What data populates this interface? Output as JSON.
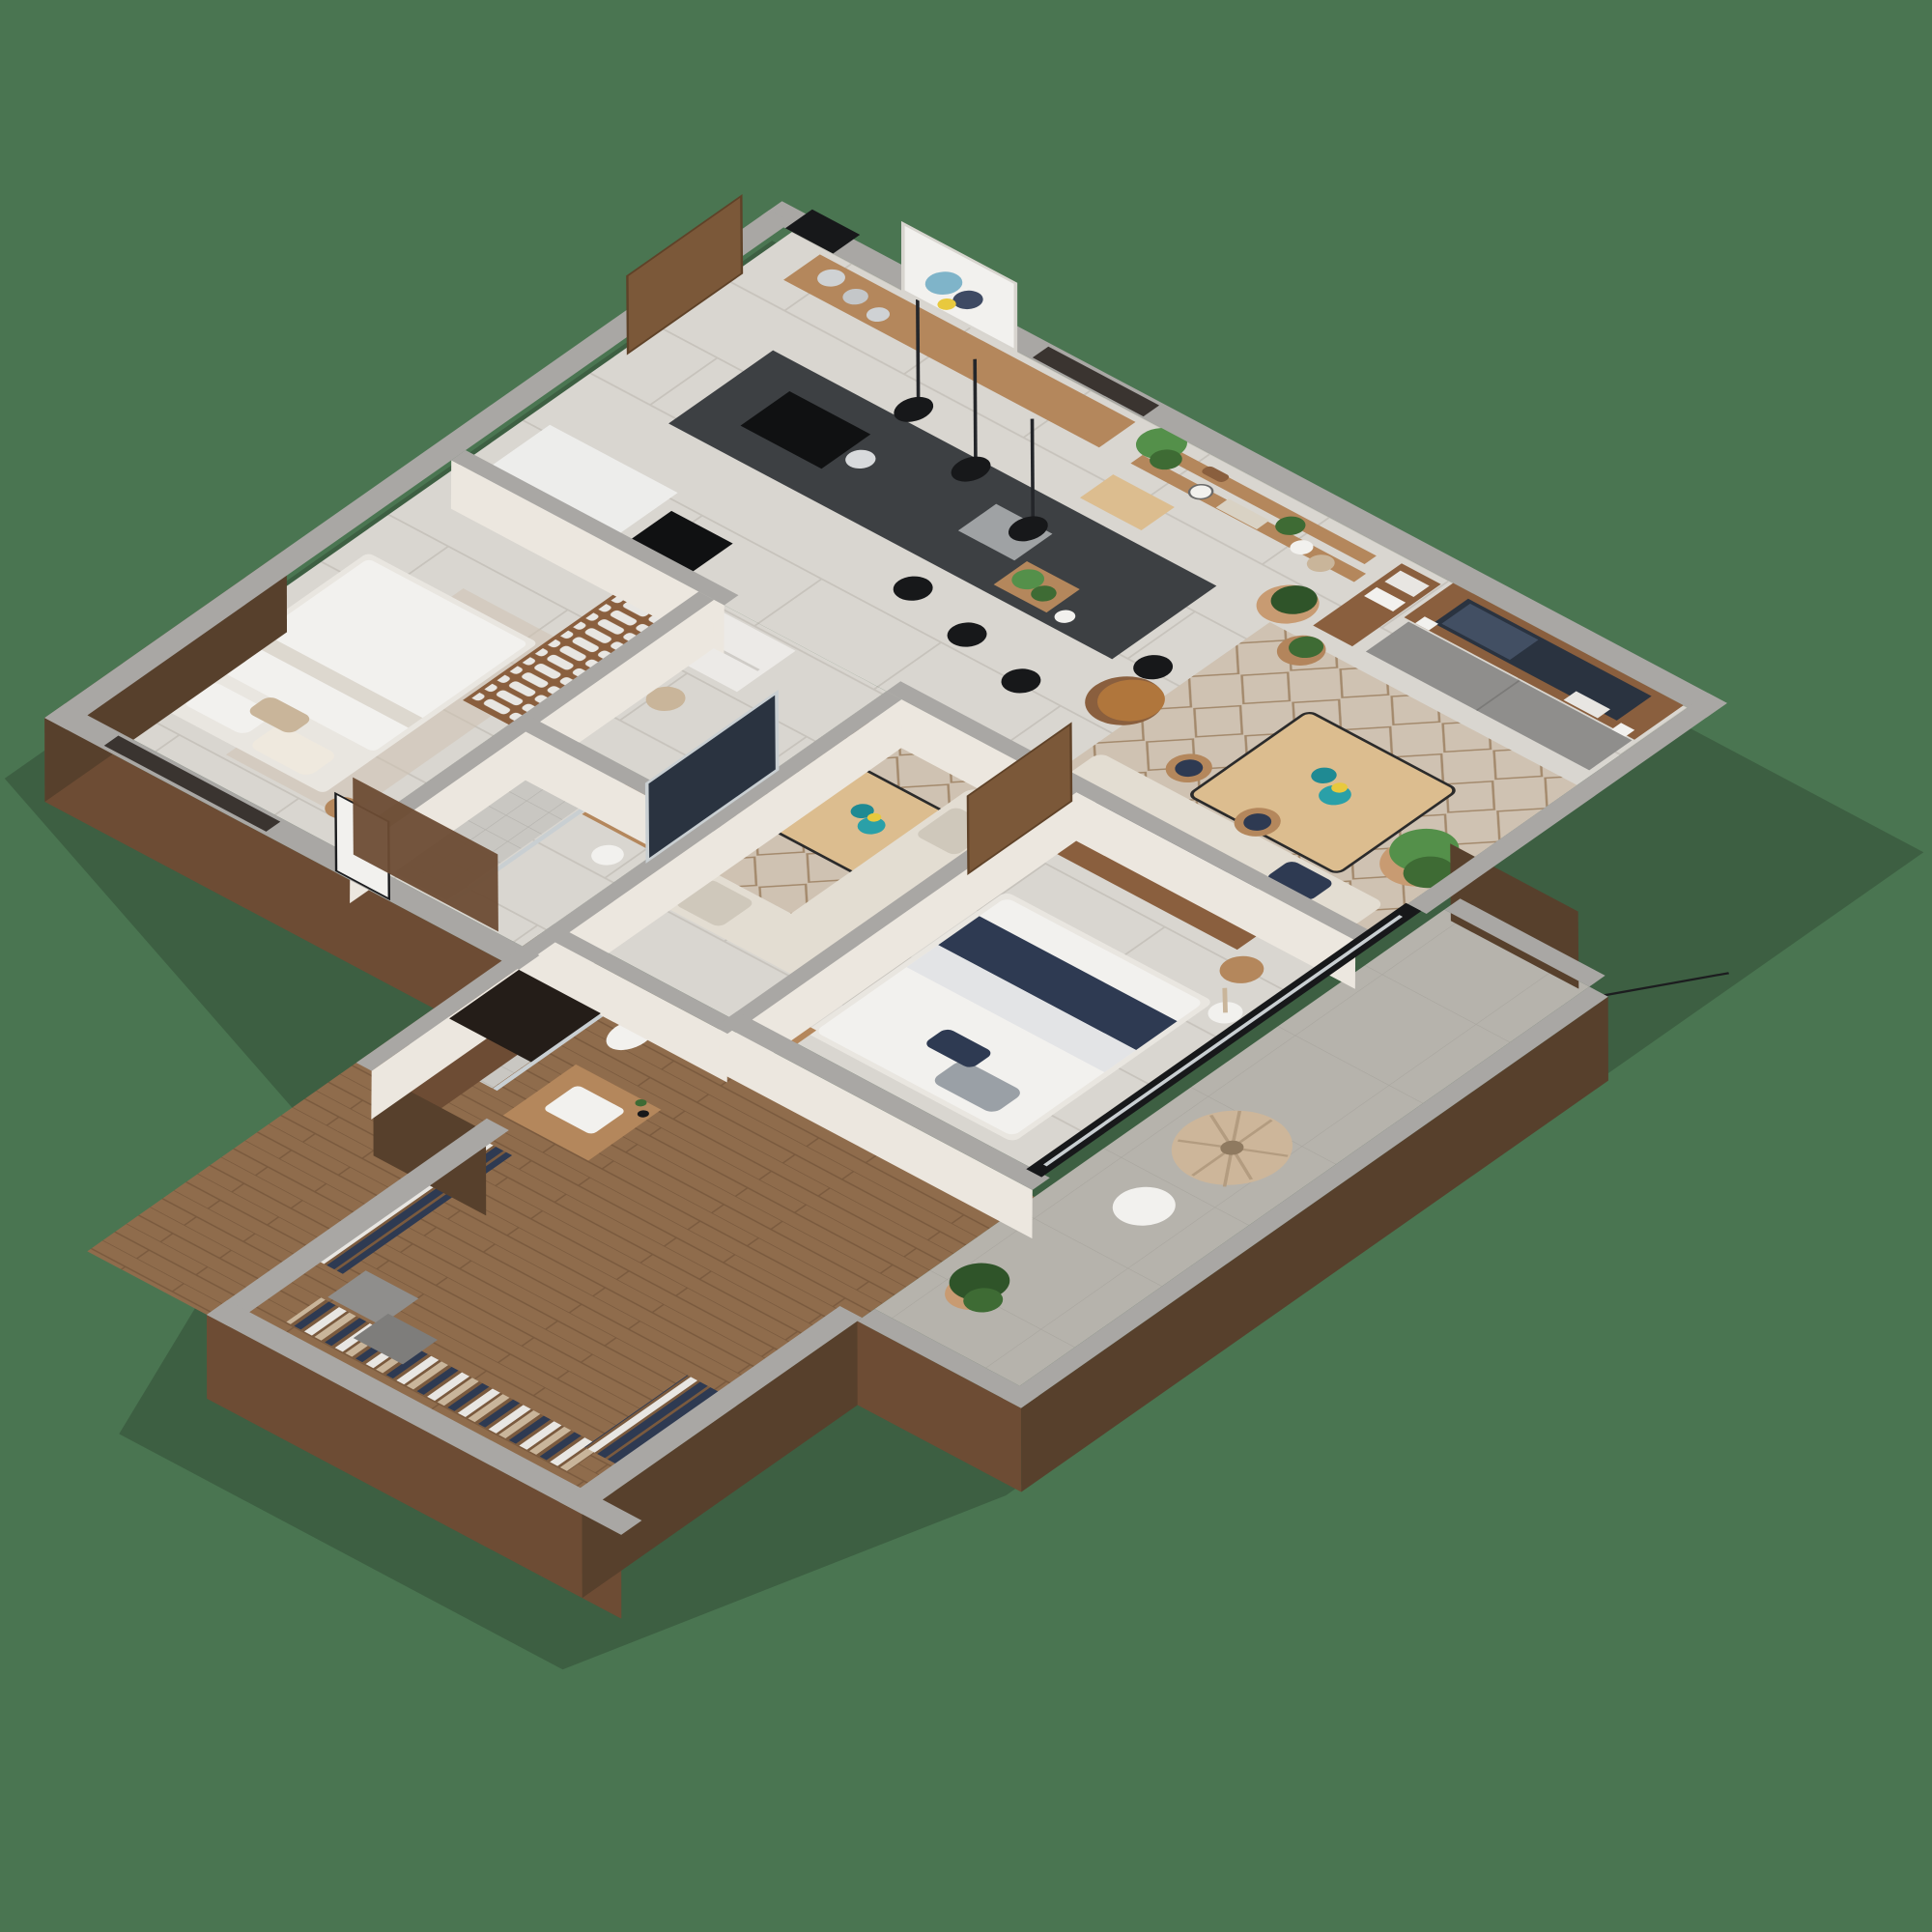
{
  "meta": {
    "image_type": "3d-isometric-floor-plan-render",
    "description": "Cutaway dollhouse view of a furnished apartment seen from above at an angle, centered on a plain green backdrop",
    "visible_text": "none"
  },
  "palette": {
    "bg": "#4a7551",
    "wall_cap": "#a9a7a4",
    "wall_cap_dark": "#908e8b",
    "wall_face": "#ece7df",
    "wood_exterior": "#6d4c34",
    "wood_exterior_dark": "#57402c",
    "tile": "#d9d6d0",
    "tile_line": "#c7c3bc",
    "wood_floor": "#8f6c4c",
    "wood_floor_line": "#7a5a3e",
    "concrete": "#b6b3ac",
    "concrete_line": "#a8a59e",
    "shower_tile": "#c9c7c2",
    "shower_line": "#b5b3ae",
    "rug": "#cfc2b2",
    "rug_line": "#a3896c",
    "island_top": "#3d4043",
    "island_base": "#d6d4d1",
    "cooktop": "#101112",
    "gray_cabinet": "#8f8e8c",
    "wood_mid": "#a97f56",
    "wood_shelf": "#b4875c",
    "wood_console": "#8a5f3e",
    "wood_table": "#dcbd8f",
    "wood_door": "#7b5839",
    "sofa": "#e3ddd2",
    "sofa_shadow": "#cfc8bb",
    "armchair": "#b0763c",
    "teal": "#1f8a93",
    "teal_light": "#2aa0a8",
    "yellow": "#e8c93e",
    "navy": "#2e3a52",
    "linen": "#e8e6e2",
    "tan_cloth": "#c9b59a",
    "plant_dark": "#2f5429",
    "plant_mid": "#3e6b34",
    "plant_light": "#54904a",
    "terracotta": "#c89b72",
    "terracotta_dark": "#b3855c",
    "acapulco": "#cdb69a",
    "white": "#f2f1ee",
    "black": "#17181a",
    "glass": "#c9cfd2",
    "dark_window": "#3a3430",
    "tv_screen": "#2a3340",
    "shadow": "rgba(30,40,30,0.28)"
  },
  "scene": {
    "rooms": [
      {
        "name": "kitchen-dining",
        "items": [
          "kitchen-island-with-cooktop",
          "kettle",
          "island-sink",
          "herb-crate",
          "bar-stools-black",
          "pendant-lights-black",
          "wall-bench-shelf",
          "metal-dishes",
          "abstract-art-frame",
          "wood-barn-door",
          "white-appliance-cabinet",
          "black-counter-inset",
          "entry-window-panels",
          "roof-vent"
        ]
      },
      {
        "name": "living-room",
        "items": [
          "wall-shelves-with-plants",
          "hanging-plant",
          "pair-of-shoes",
          "wall-clock",
          "books",
          "floor-plants-terracotta",
          "tv-media-wall",
          "gray-sideboard",
          "bookshelf",
          "photo-frames",
          "leather-armchair",
          "geometric-rug",
          "wood-coffee-table",
          "teal-vases",
          "dining-bench-sofa",
          "wood-back-chairs",
          "floor-lamp",
          "wood-side-bench",
          "large-potted-plant"
        ]
      },
      {
        "name": "small-bedroom",
        "items": [
          "double-bed-white",
          "pillows",
          "bedside-stool",
          "window-dark-screen",
          "linen-wardrobe-with-folded-towels"
        ]
      },
      {
        "name": "hallway",
        "items": [
          "washing-machine-white",
          "round-pouf"
        ]
      },
      {
        "name": "bathroom-1",
        "items": [
          "tiled-shower",
          "glass-screen",
          "vessel-sink-on-wood-vanity",
          "towel",
          "wall-mounted-tv-on-glass-divider",
          "wood-partition"
        ]
      },
      {
        "name": "master-bedroom",
        "items": [
          "double-bed-white-navy-throw",
          "gray-pillow",
          "wood-tv-console",
          "flat-tv",
          "sliding-wood-door",
          "bedside-table-with-lamp",
          "round-wood-stool",
          "glass-sliding-doors-black-frame",
          "floor-lamp-white"
        ]
      },
      {
        "name": "ensuite-bathroom",
        "items": [
          "tiled-shower",
          "toilet",
          "wood-vanity-with-white-sink",
          "toiletry-bottles"
        ]
      },
      {
        "name": "walk-in-closet",
        "items": [
          "wood-plank-floor",
          "hanging-clothes-white",
          "hanging-clothes-navy",
          "hanging-jeans",
          "gray-drawer-boxes"
        ]
      },
      {
        "name": "balcony",
        "items": [
          "concrete-floor",
          "acapulco-chair",
          "round-side-table-white",
          "privacy-wood-panel",
          "potted-fiddle-leaf-plant",
          "railing-wire"
        ]
      }
    ],
    "exterior": [
      "green-backdrop",
      "gray-wall-caps",
      "brown-wood-cladding",
      "cast-shadow"
    ]
  }
}
